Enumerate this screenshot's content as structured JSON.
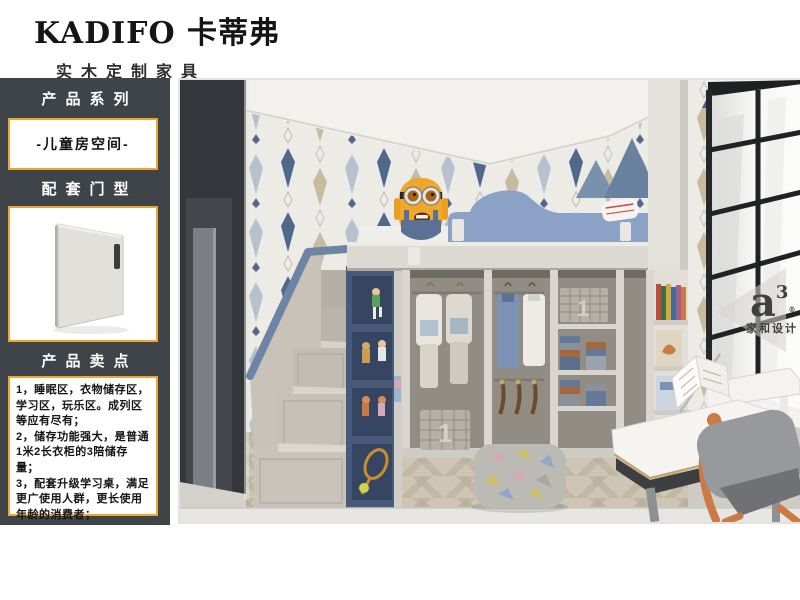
{
  "brand": {
    "logo": "KADIFO 卡蒂弗",
    "tagline": "实木定制家具"
  },
  "sidebar": {
    "series_header": "产品系列",
    "series_value": "-儿童房空间-",
    "door_header": "配套门型",
    "selling_header": "产品卖点",
    "selling_points": [
      "1，睡眠区，衣物储存区，学习区，玩乐区。成列区等应有尽有；",
      "2，储存功能强大，是普通1米2长衣柜的3陪储存量；",
      "3，配套升级学习桌，满足更广使用人群，更长使用年龄的消费者；"
    ],
    "colors": {
      "background": "#3f4449",
      "accent": "#efa72f"
    }
  },
  "photo": {
    "scene": "children-room-loft-bed-wardrobe-study-desk",
    "watermark": {
      "logo": "a",
      "sup": "3",
      "reg": "®",
      "name": "家和设计"
    },
    "basket_label": "1",
    "colors": {
      "wall_triangle_blue": "#67819f",
      "bed_rail_blue": "#8ba1c6",
      "shelf_navy": "#49597a",
      "stairs_gray": "#c6c0b7",
      "stair_trim_blue": "#6e84a4",
      "dark_wall": "#33363a",
      "floor_wood": "#c7bcab",
      "minion_yellow": "#f0a82b",
      "chair_orange": "#c97a45"
    }
  }
}
